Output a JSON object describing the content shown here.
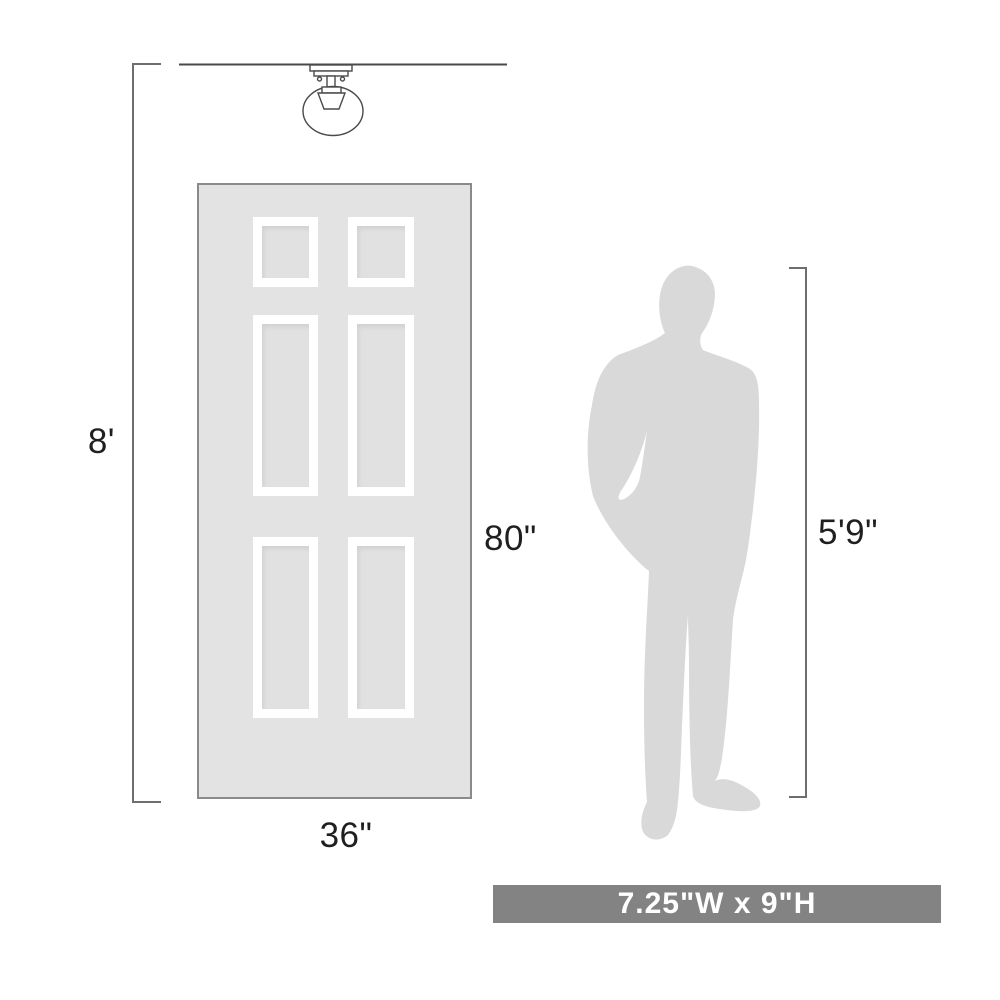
{
  "labels": {
    "ceiling_height": "8'",
    "door_height": "80\"",
    "door_width": "36\"",
    "person_height": "5'9\"",
    "fixture_dimensions": "7.25\"W x 9\"H"
  },
  "graphics": {
    "ceiling_light": "flush-mount-globe-light-line-drawing",
    "door": "six-panel-door",
    "person": "standing-man-silhouette"
  },
  "colors": {
    "background": "#ffffff",
    "door_fill": "#e3e3e3",
    "door_border": "#8a8a8a",
    "panel_frame": "#ffffff",
    "silhouette_fill": "#d9d9d9",
    "banner_bg": "#838383",
    "banner_text": "#ffffff",
    "dimension_line": "#6e6e6e",
    "artwork_line": "#4a4a4a",
    "label_text": "#1f1f1f"
  }
}
